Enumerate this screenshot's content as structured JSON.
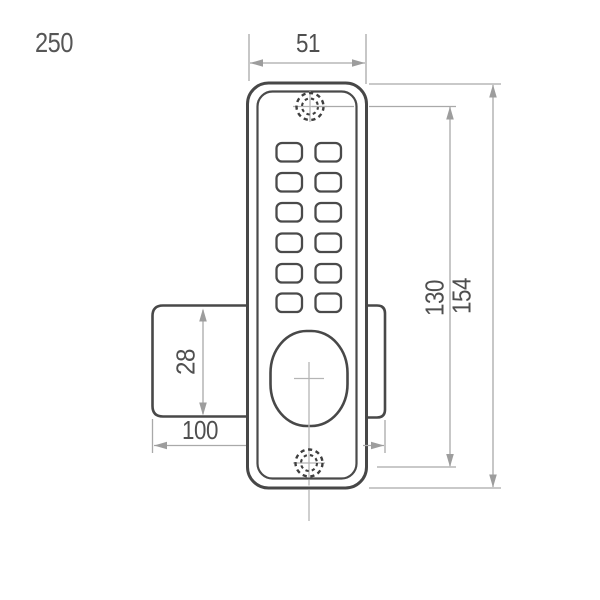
{
  "drawing": {
    "reference_label": "250",
    "dimensions": {
      "body_width": "51",
      "screw_spacing": "130",
      "body_height": "154",
      "latch_height": "28",
      "latch_length": "100"
    },
    "colors": {
      "part_outline": "#484848",
      "dimension_lines": "#a9a9a9",
      "arrowheads": "#9d9d9d",
      "dimension_text": "#4f4f4f",
      "background": "#ffffff"
    }
  }
}
